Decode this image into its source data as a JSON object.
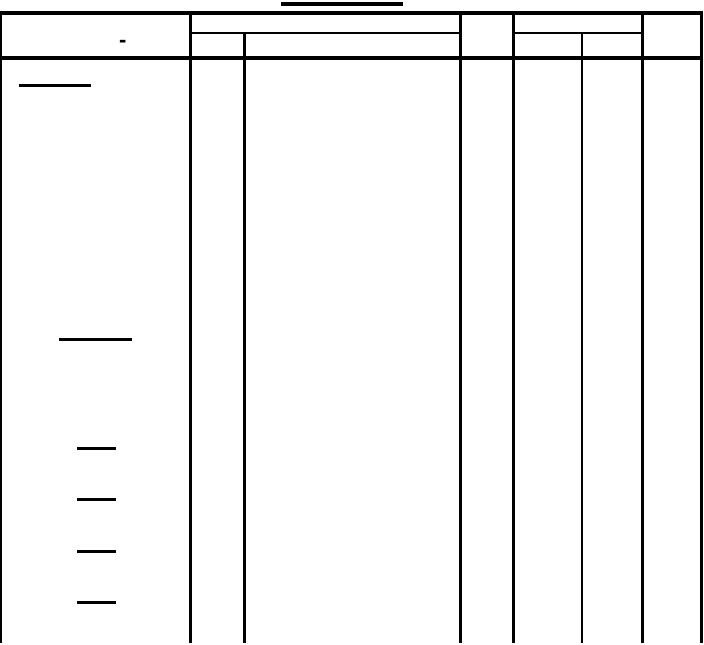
{
  "page": {
    "background_color": "#ffffff",
    "ink_color": "#000000"
  },
  "table": {
    "header": {
      "col1_dash": "-",
      "col1_label": "",
      "group1_top_label": "",
      "group1_sub1_label": "",
      "group1_sub2_label": "",
      "col3_label": "",
      "group2_top_label": "",
      "group2_sub1_label": "",
      "group2_sub2_label": "",
      "col5_label": ""
    },
    "body": {
      "blank_underline_count": 6
    },
    "title_text": ""
  }
}
